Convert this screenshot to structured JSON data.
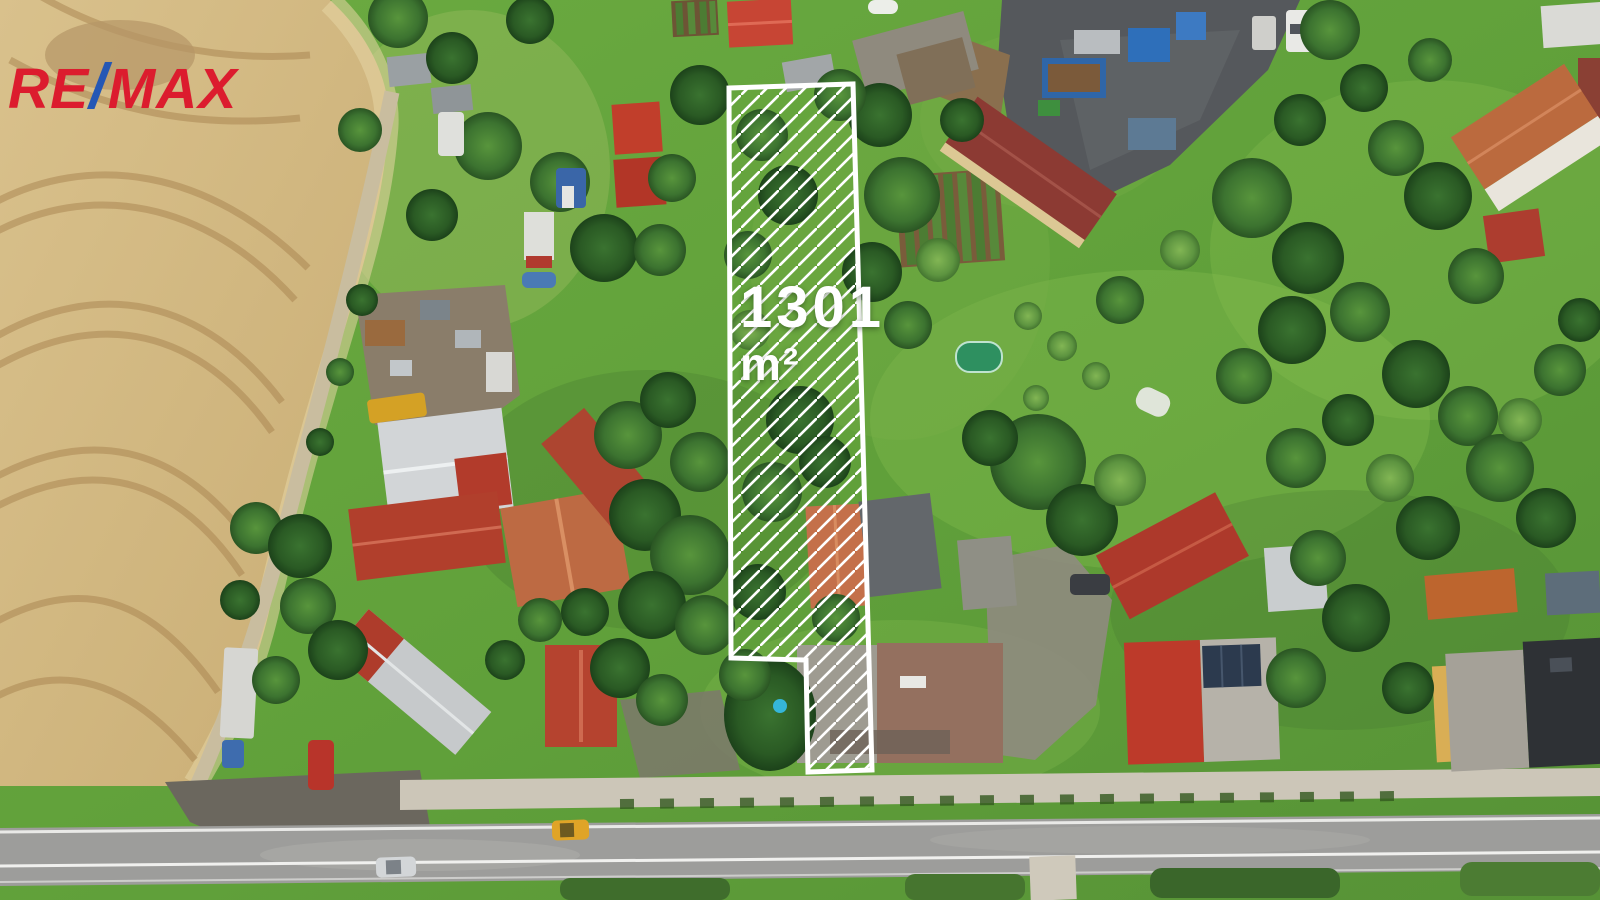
{
  "brand": {
    "name_full": "RE/MAX",
    "segments": [
      {
        "text": "RE",
        "color": "#dc1c2e"
      },
      {
        "text": "/",
        "color": "#2457b5"
      },
      {
        "text": "MAX",
        "color": "#dc1c2e"
      }
    ]
  },
  "parcel_overlay": {
    "area_value": "1301",
    "area_unit": "m²",
    "outline_color": "#ffffff"
  }
}
